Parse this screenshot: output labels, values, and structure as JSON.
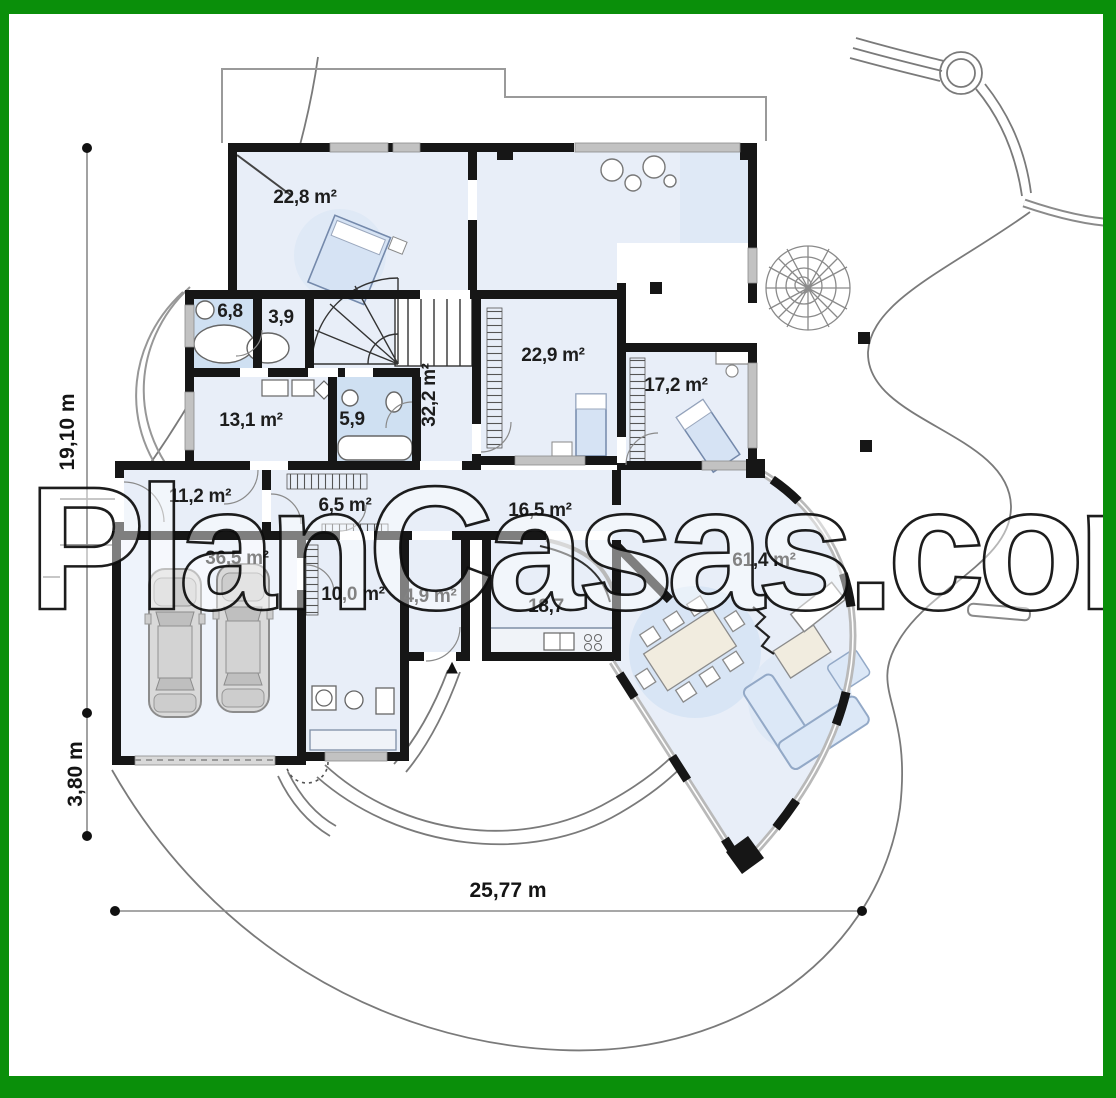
{
  "watermark": "PlanCasas.com",
  "frame_color": "#0a8f0a",
  "entrance_marker": "▲",
  "dimensions": {
    "height_total": "19,10 m",
    "height_offset": "3,80 m",
    "width_total": "25,77 m"
  },
  "rooms": [
    {
      "id": "bedroom-22-8",
      "area": "22,8 m²"
    },
    {
      "id": "bath-6-8",
      "area": "6,8"
    },
    {
      "id": "wardrobe-3-9",
      "area": "3,9"
    },
    {
      "id": "hall-32-2",
      "area": "32,2 m²"
    },
    {
      "id": "bedroom-22-9",
      "area": "22,9 m²"
    },
    {
      "id": "bedroom-17-2",
      "area": "17,2 m²"
    },
    {
      "id": "room-13-1",
      "area": "13,1 m²"
    },
    {
      "id": "bath-5-9",
      "area": "5,9"
    },
    {
      "id": "vestibule-11-2",
      "area": "11,2 m²"
    },
    {
      "id": "hall-6-5",
      "area": "6,5 m²"
    },
    {
      "id": "dining-16-5",
      "area": "16,5 m²"
    },
    {
      "id": "garage-36-5",
      "area": "36,5 m²"
    },
    {
      "id": "utility-10-0",
      "area": "10,0 m²"
    },
    {
      "id": "pantry-4-9",
      "area": "4,9 m²"
    },
    {
      "id": "kitchen-18-7",
      "area": "18,7"
    },
    {
      "id": "living-61-4",
      "area": "61,4 m²"
    }
  ]
}
